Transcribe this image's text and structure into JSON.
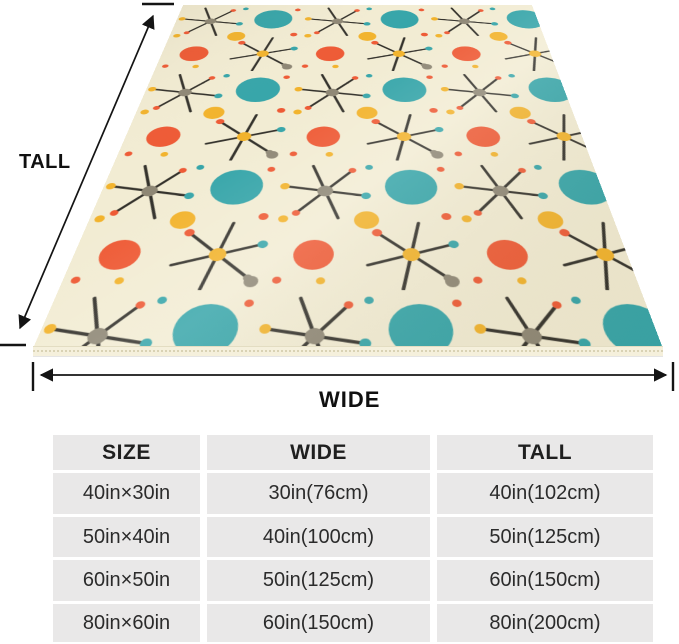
{
  "figure": {
    "tall_label": "TALL",
    "wide_label": "WIDE",
    "pattern_style": "mid-century atomic starburst blanket",
    "pattern_colors": {
      "background": "#f2ecd3",
      "teal": "#36a5a9",
      "orange_red": "#ee5a35",
      "yellow": "#f2b32c",
      "gray": "#8e8775",
      "starburst_line": "#33312b"
    }
  },
  "size_table": {
    "headers": [
      "SIZE",
      "WIDE",
      "TALL"
    ],
    "rows": [
      [
        "40in×30in",
        "30in(76cm)",
        "40in(102cm)"
      ],
      [
        "50in×40in",
        "40in(100cm)",
        "50in(125cm)"
      ],
      [
        "60in×50in",
        "50in(125cm)",
        "60in(150cm)"
      ],
      [
        "80in×60in",
        "60in(150cm)",
        "80in(200cm)"
      ]
    ]
  }
}
